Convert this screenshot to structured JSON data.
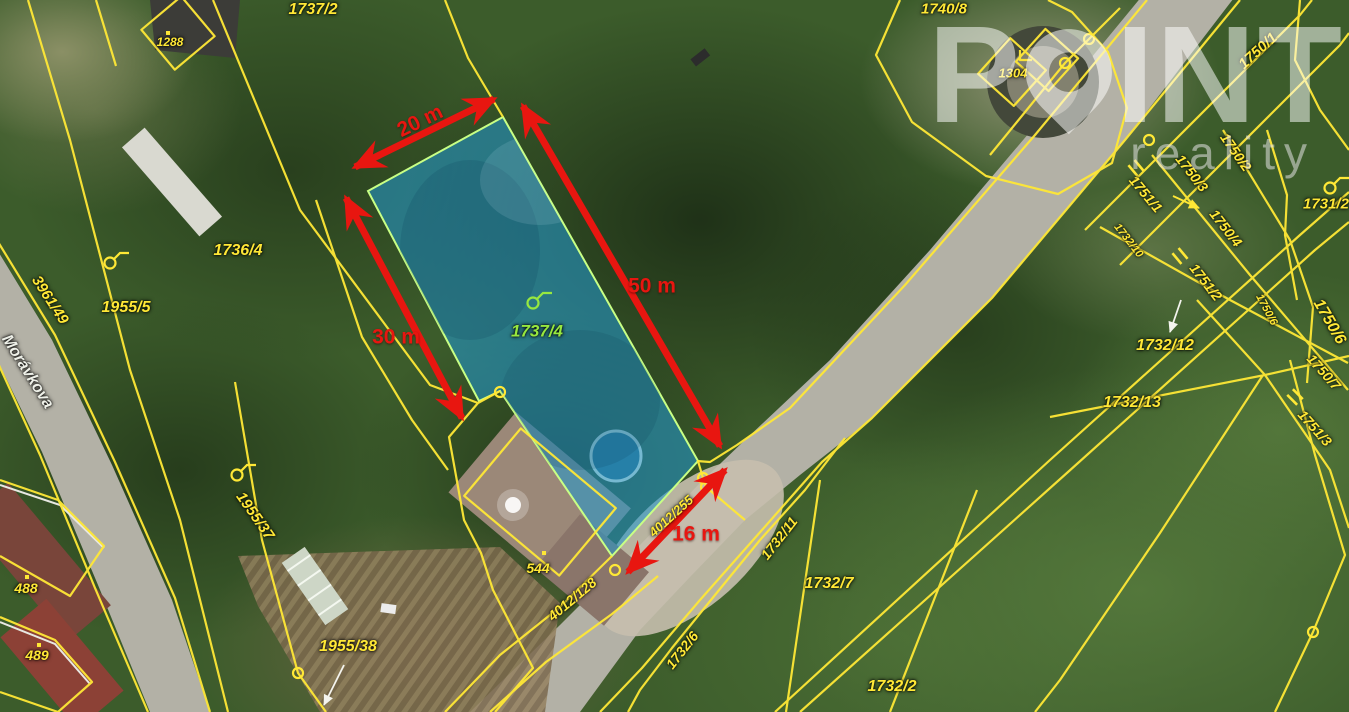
{
  "watermark": {
    "brand_prefix": "P",
    "brand_suffix": "INT",
    "subtitle": "reality"
  },
  "map": {
    "street_name": "Morávkova",
    "highlighted_parcel": {
      "id": "1737/4",
      "fill": "#2497cc",
      "outline": "#c8ff85"
    },
    "colors": {
      "parcel_line": "#ffe836",
      "dimension": "#e81610",
      "label_green": "#97e83f",
      "label_white": "#eef0e8"
    },
    "parcel_labels": [
      {
        "text": "1737/2",
        "x": 313,
        "y": 10,
        "rot": 0,
        "size": 16
      },
      {
        "text": "1740/8",
        "x": 944,
        "y": 9,
        "rot": 0,
        "size": 15
      },
      {
        "text": "1288",
        "x": 170,
        "y": 42,
        "rot": 0,
        "size": 12
      },
      {
        "text": "1304",
        "x": 1013,
        "y": 73,
        "rot": 0,
        "size": 13
      },
      {
        "text": "1750/1",
        "x": 1258,
        "y": 51,
        "rot": -42,
        "size": 15
      },
      {
        "text": "1731/2",
        "x": 1326,
        "y": 204,
        "rot": 0,
        "size": 15
      },
      {
        "text": "Morávkova",
        "x": 27,
        "y": 372,
        "rot": 58,
        "size": 16,
        "color": "white"
      },
      {
        "text": "3961/49",
        "x": 50,
        "y": 300,
        "rot": 57,
        "size": 15
      },
      {
        "text": "1955/5",
        "x": 126,
        "y": 308,
        "rot": 0,
        "size": 16
      },
      {
        "text": "1736/4",
        "x": 238,
        "y": 251,
        "rot": 0,
        "size": 16
      },
      {
        "text": "1955/37",
        "x": 255,
        "y": 516,
        "rot": 55,
        "size": 15
      },
      {
        "text": "488",
        "x": 26,
        "y": 588,
        "rot": 0,
        "size": 14
      },
      {
        "text": "489",
        "x": 37,
        "y": 655,
        "rot": 0,
        "size": 14
      },
      {
        "text": "1955/38",
        "x": 348,
        "y": 647,
        "rot": 0,
        "size": 16
      },
      {
        "text": "544",
        "x": 538,
        "y": 568,
        "rot": 0,
        "size": 14
      },
      {
        "text": "1737/4",
        "x": 537,
        "y": 331,
        "rot": 0,
        "size": 17,
        "color": "green"
      },
      {
        "text": "4012/255",
        "x": 671,
        "y": 516,
        "rot": -42,
        "size": 13
      },
      {
        "text": "4012/128",
        "x": 572,
        "y": 599,
        "rot": -40,
        "size": 14
      },
      {
        "text": "1732/6",
        "x": 682,
        "y": 650,
        "rot": -52,
        "size": 14
      },
      {
        "text": "1732/11",
        "x": 779,
        "y": 538,
        "rot": -52,
        "size": 14
      },
      {
        "text": "1732/7",
        "x": 829,
        "y": 584,
        "rot": 0,
        "size": 16
      },
      {
        "text": "1732/2",
        "x": 892,
        "y": 687,
        "rot": 0,
        "size": 16
      },
      {
        "text": "1732/12",
        "x": 1165,
        "y": 346,
        "rot": 0,
        "size": 16
      },
      {
        "text": "1732/13",
        "x": 1132,
        "y": 403,
        "rot": 0,
        "size": 16
      },
      {
        "text": "1732/10",
        "x": 1128,
        "y": 241,
        "rot": 52,
        "size": 11
      },
      {
        "text": "1751/1",
        "x": 1146,
        "y": 194,
        "rot": 50,
        "size": 14
      },
      {
        "text": "1750/3",
        "x": 1192,
        "y": 173,
        "rot": 52,
        "size": 14
      },
      {
        "text": "1750/2",
        "x": 1236,
        "y": 152,
        "rot": 55,
        "size": 14
      },
      {
        "text": "1750/4",
        "x": 1226,
        "y": 228,
        "rot": 52,
        "size": 14
      },
      {
        "text": "1751/2",
        "x": 1206,
        "y": 282,
        "rot": 52,
        "size": 14
      },
      {
        "text": "1750/6",
        "x": 1266,
        "y": 310,
        "rot": 62,
        "size": 11
      },
      {
        "text": "1750/6",
        "x": 1329,
        "y": 322,
        "rot": 60,
        "size": 16
      },
      {
        "text": "1750/7",
        "x": 1324,
        "y": 372,
        "rot": 48,
        "size": 14
      },
      {
        "text": "1751/3",
        "x": 1315,
        "y": 428,
        "rot": 48,
        "size": 14
      }
    ],
    "dimensions": [
      {
        "label": "20 m",
        "x1": 355,
        "y1": 167,
        "x2": 494,
        "y2": 99,
        "lx": 420,
        "ly": 121,
        "lrot": -26
      },
      {
        "label": "50 m",
        "x1": 523,
        "y1": 106,
        "x2": 720,
        "y2": 446,
        "lx": 652,
        "ly": 286,
        "lrot": 0
      },
      {
        "label": "30 m",
        "x1": 346,
        "y1": 198,
        "x2": 462,
        "y2": 418,
        "lx": 396,
        "ly": 337,
        "lrot": 0
      },
      {
        "label": "16 m",
        "x1": 725,
        "y1": 470,
        "x2": 628,
        "y2": 572,
        "lx": 696,
        "ly": 534,
        "lrot": 0
      }
    ],
    "symbols": {
      "hooks": [
        {
          "x": 110,
          "y": 263
        },
        {
          "x": 237,
          "y": 475
        },
        {
          "x": 1330,
          "y": 188
        },
        {
          "x": 533,
          "y": 303,
          "color": "green"
        }
      ],
      "circles": [
        [
          500,
          392
        ],
        [
          703,
          478
        ],
        [
          706,
          487
        ],
        [
          615,
          570
        ],
        [
          298,
          673
        ],
        [
          1089,
          39
        ],
        [
          1065,
          63
        ],
        [
          1149,
          140
        ],
        [
          1313,
          632
        ]
      ],
      "ticks": [
        [
          1136,
          168,
          -40
        ],
        [
          1180,
          256,
          -40
        ],
        [
          1295,
          397,
          -45
        ]
      ],
      "dots": [
        [
          27,
          577
        ],
        [
          39,
          645
        ],
        [
          544,
          553
        ],
        [
          168,
          33
        ]
      ],
      "pointer_arrows": [
        {
          "x1": 1173,
          "y1": 196,
          "x2": 1199,
          "y2": 208,
          "color": "#ffe836"
        },
        {
          "x1": 1181,
          "y1": 300,
          "x2": 1170,
          "y2": 332,
          "color": "#f4f4ee"
        },
        {
          "x1": 344,
          "y1": 665,
          "x2": 324,
          "y2": 705,
          "color": "#f4f4ee"
        }
      ]
    }
  }
}
